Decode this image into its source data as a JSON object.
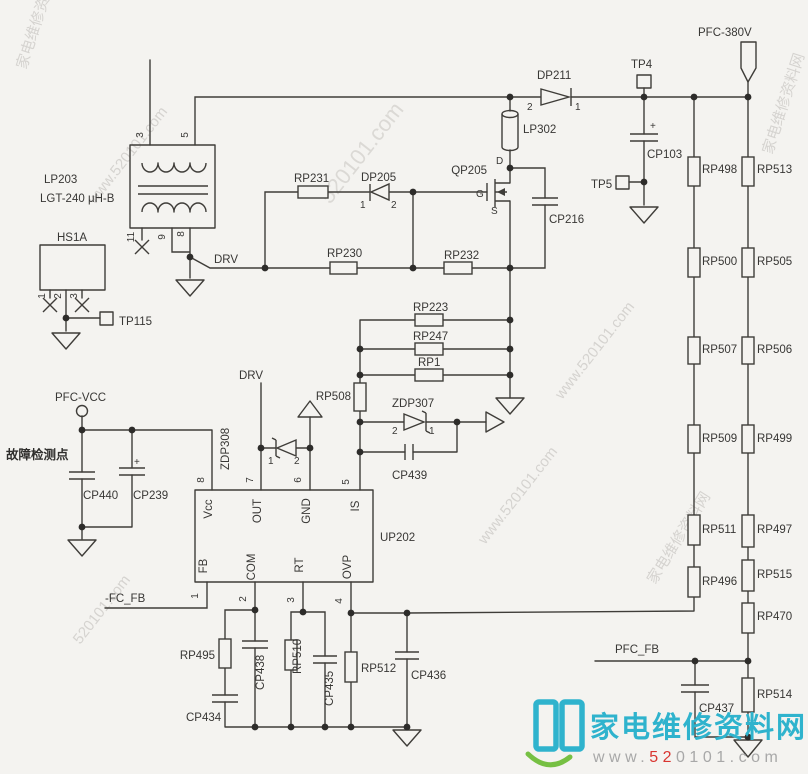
{
  "labels": {
    "pfc380v": "PFC-380V",
    "tp4": "TP4",
    "tp5": "TP5",
    "tp115": "TP115",
    "dp211": "DP211",
    "dp211_a": "2",
    "dp211_k": "1",
    "lp302": "LP302",
    "cp103": "CP103",
    "plus": "+",
    "lp203": "LP203",
    "lp203_value": "LGT-240 μH-B",
    "pin3": "3",
    "pin5": "5",
    "pin11": "11",
    "pin9": "9",
    "pin8": "8",
    "hs1a": "HS1A",
    "hs1a_p1": "1",
    "hs1a_p2": "2",
    "hs1a_p3": "3",
    "drv": "DRV",
    "rp231": "RP231",
    "dp205": "DP205",
    "dp205_1": "1",
    "dp205_2": "2",
    "rp230": "RP230",
    "rp232": "RP232",
    "qp205": "QP205",
    "pin_d": "D",
    "pin_g": "G",
    "pin_s": "S",
    "cp216": "CP216",
    "rp223": "RP223",
    "rp247": "RP247",
    "rp1": "RP1",
    "rp508": "RP508",
    "zdp307": "ZDP307",
    "zdp307_2": "2",
    "zdp307_1": "1",
    "cp439": "CP439",
    "zdp308": "ZDP308",
    "zdp308_1": "1",
    "zdp308_2": "2",
    "pfc_vcc": "PFC-VCC",
    "fault_note": "故障检测点",
    "cp440": "CP440",
    "cp239": "CP239",
    "up202": "UP202",
    "n8": "8",
    "n7": "7",
    "n6": "6",
    "n5": "5",
    "n1": "1",
    "n2": "2",
    "n3": "3",
    "n4": "4",
    "vcc": "Vcc",
    "out": "OUT",
    "gnd": "GND",
    "is_pin": "IS",
    "fb": "FB",
    "com": "COM",
    "rt": "RT",
    "ovp": "OVP",
    "fc_fb": "-FC_FB",
    "rp495": "RP495",
    "cp438": "CP438",
    "cp434": "CP434",
    "rp510": "RP510",
    "cp435": "CP435",
    "rp512": "RP512",
    "cp436": "CP436",
    "rp498": "RP498",
    "rp500": "RP500",
    "rp507": "RP507",
    "rp509": "RP509",
    "rp511": "RP511",
    "rp496": "RP496",
    "rp513": "RP513",
    "rp505": "RP505",
    "rp506": "RP506",
    "rp499": "RP499",
    "rp497": "RP497",
    "rp515": "RP515",
    "rp470": "RP470",
    "rp514": "RP514",
    "pfc_fb": "PFC_FB",
    "cp437": "CP437"
  },
  "watermark": {
    "site": "家电维修资料网",
    "url": "www.520101.com",
    "url_short": "520101.com"
  },
  "logo": {
    "site": "家电维修资料网",
    "url_www": "www.",
    "url_red": "52",
    "url_rest": "0101.com"
  }
}
